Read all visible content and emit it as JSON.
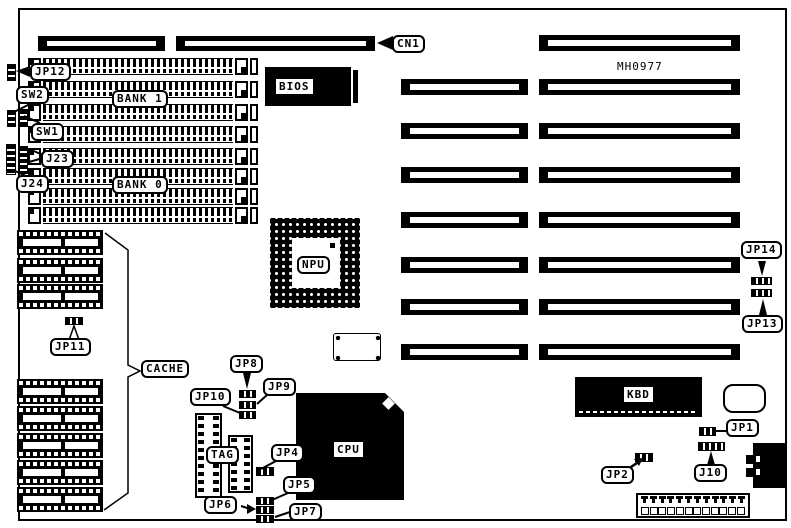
{
  "board": {
    "part_number": "MH0977"
  },
  "callouts": {
    "cn1": "CN1",
    "jp12": "JP12",
    "sw2": "SW2",
    "sw1": "SW1",
    "j23": "J23",
    "j24": "J24",
    "bank1": "BANK 1",
    "bank0": "BANK 0",
    "jp11": "JP11",
    "cache": "CACHE",
    "jp8": "JP8",
    "jp9": "JP9",
    "jp10": "JP10",
    "jp4": "JP4",
    "jp5": "JP5",
    "jp6": "JP6",
    "jp7": "JP7",
    "tag": "TAG",
    "npu": "NPU",
    "jp14": "JP14",
    "jp13": "JP13",
    "jp1": "JP1",
    "j10": "J10",
    "jp2": "JP2"
  },
  "chip_labels": {
    "bios": "BIOS",
    "cpu": "CPU",
    "kbd": "KBD"
  },
  "colors": {
    "ink": "#000000",
    "paper": "#ffffff"
  }
}
